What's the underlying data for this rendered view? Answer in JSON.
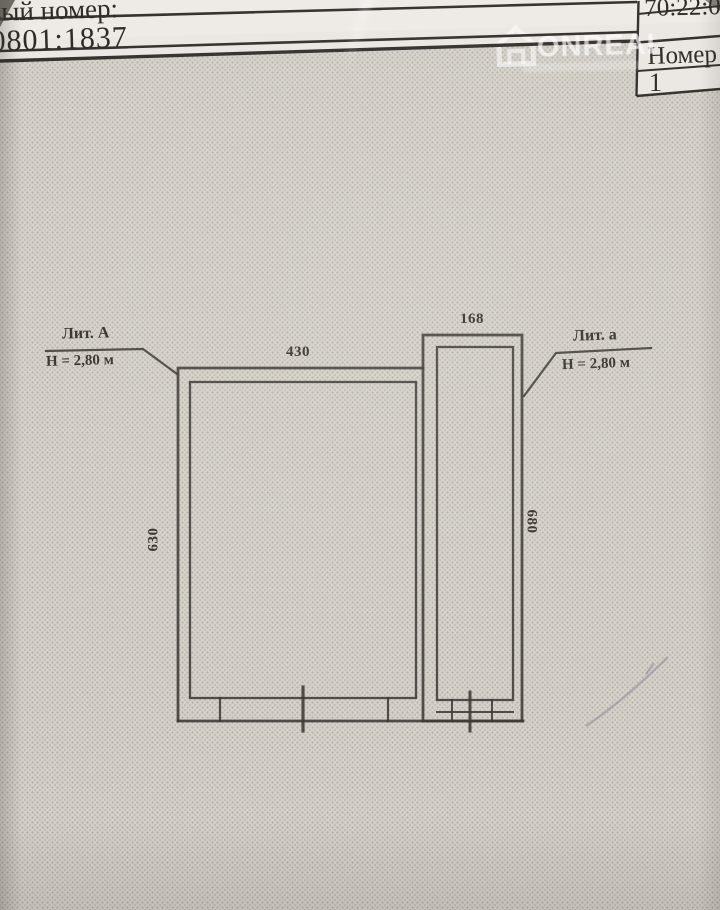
{
  "header": {
    "cadastral_label_partial": "вый номер:",
    "cadastral_value_partial": "0801:1837",
    "top_right_number_partial": "70:22:0",
    "box_label_partial": "Номер э",
    "box_value": "1"
  },
  "watermark": {
    "text": "ONREALT"
  },
  "plan": {
    "main_building": {
      "litera": "Лит. А",
      "height_note": "Н = 2,80 м",
      "top_dim": "430",
      "side_dim": "630"
    },
    "annex": {
      "litera": "Лит. а",
      "height_note": "Н = 2,80 м",
      "top_dim": "168",
      "side_dim": "680"
    }
  },
  "colors": {
    "paper": "#d7d3ca",
    "header_paper": "#eae7e2",
    "ink": "#35322d",
    "pencil_mark": "#8a8794"
  }
}
